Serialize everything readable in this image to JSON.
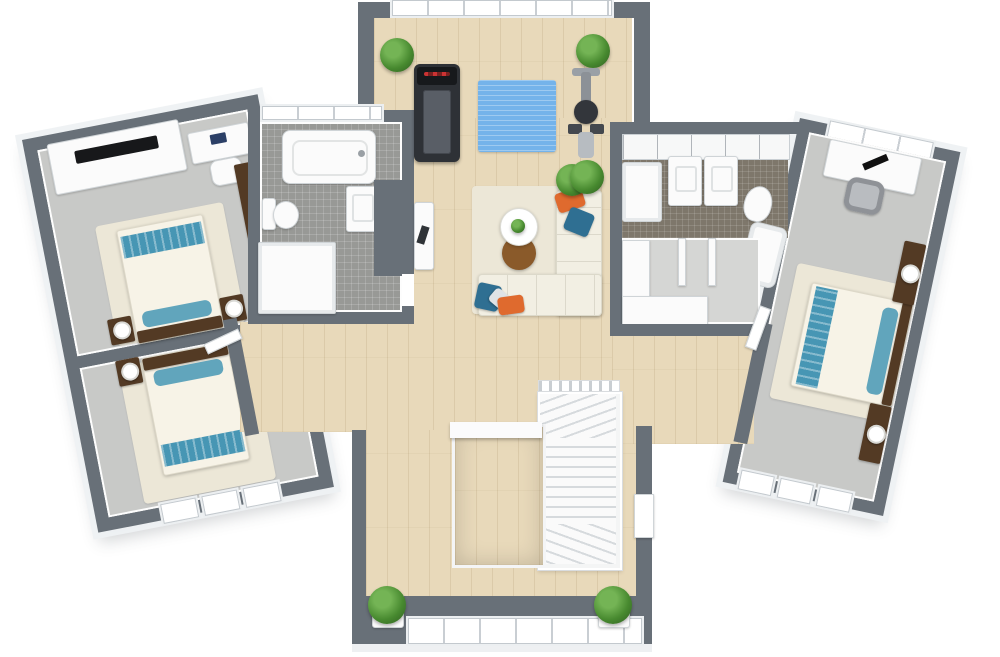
{
  "scene": {
    "kind": "3d-floorplan-top-view",
    "rooms": [
      {
        "id": "gym",
        "floor": "wood",
        "furniture": [
          "treadmill",
          "exercise-mat",
          "elliptical-trainer",
          "potted-plant",
          "potted-plant",
          "potted-plant"
        ]
      },
      {
        "id": "lounge",
        "floor": "wood",
        "furniture": [
          "sectional-sofa",
          "round-coffee-table",
          "round-side-table",
          "throw-pillow-orange",
          "throw-pillow-blue",
          "potted-plant",
          "table-plant"
        ]
      },
      {
        "id": "bedroom-upper-left",
        "floor": "carpet",
        "furniture": [
          "tv-console",
          "tv",
          "desk",
          "desk-chair",
          "wardrobe",
          "double-bed",
          "nightstand",
          "nightstand",
          "table-lamp",
          "table-lamp",
          "rug"
        ]
      },
      {
        "id": "bedroom-lower-left",
        "floor": "carpet",
        "furniture": [
          "double-bed",
          "nightstand",
          "nightstand",
          "table-lamp",
          "table-lamp",
          "rug"
        ],
        "windows": 3
      },
      {
        "id": "bathroom-left",
        "floor": "tile",
        "furniture": [
          "bathtub",
          "toilet",
          "shower",
          "sink-vanity",
          "partition-wall",
          "hall-console"
        ]
      },
      {
        "id": "bathroom-right",
        "floor": "dark-tile",
        "furniture": [
          "shower",
          "sink-vanity",
          "sink-vanity",
          "toilet",
          "bathtub"
        ]
      },
      {
        "id": "walk-in-closet",
        "floor": "carpet",
        "furniture": [
          "wardrobe-shelving-l",
          "closet-partition",
          "closet-partition"
        ]
      },
      {
        "id": "bedroom-right",
        "floor": "carpet",
        "furniture": [
          "desk",
          "office-chair",
          "double-bed",
          "nightstand",
          "nightstand",
          "table-lamp",
          "table-lamp",
          "rug"
        ],
        "windows": 4
      },
      {
        "id": "stair-hall",
        "floor": "wood",
        "furniture": [
          "u-shaped-staircase",
          "stairwell-void",
          "potted-plant",
          "potted-plant"
        ],
        "windows": 1
      }
    ]
  },
  "colors": {
    "wall": "#687078",
    "wood": "#e8d9ba",
    "carpet": "#c8c9c7",
    "carpet_light": "#d5d6d4",
    "tile": "#989996",
    "tile_dark": "#7e776b",
    "rug": "#ece7d7",
    "sofa": "#f2efe3",
    "white_fixture": "#fbfbfb",
    "teal": "#4796b4",
    "bed_white": "#f7f3e7",
    "wood_dark_brown": "#533a24",
    "table_brown": "#8a5a2a",
    "pillow_orange": "#df6a2e",
    "pillow_blue": "#2f6f92",
    "mat_blue": "#74b3ea",
    "plant": "#47892f",
    "equipment_dark": "#2e3136",
    "stair_line": "#d6dadd"
  }
}
